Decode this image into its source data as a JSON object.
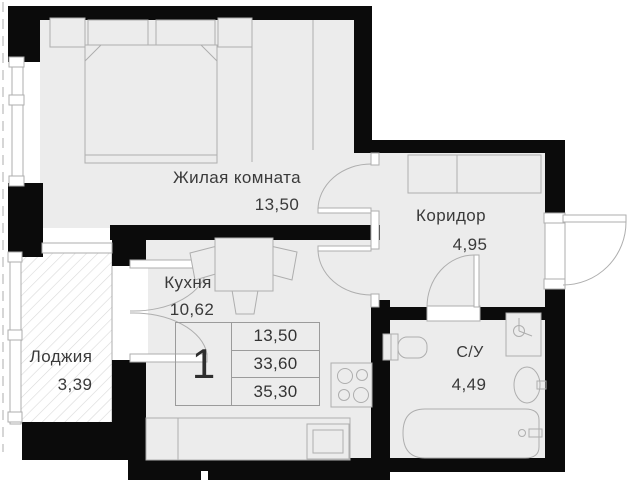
{
  "rooms": {
    "living": {
      "name": "Жилая комната",
      "area": "13,50"
    },
    "corridor": {
      "name": "Коридор",
      "area": "4,95"
    },
    "kitchen": {
      "name": "Кухня",
      "area": "10,62"
    },
    "loggia": {
      "name": "Лоджия",
      "area": "3,39"
    },
    "bathroom": {
      "name": "С/У",
      "area": "4,49"
    }
  },
  "info_table": {
    "apartment_number": "1",
    "rows": [
      "13,50",
      "33,60",
      "35,30"
    ]
  },
  "colors": {
    "wall": "#0b0b0b",
    "floor": "#ececec",
    "line": "#aeaeae",
    "hatch": "#d9d9d9",
    "text": "#3a3a3a"
  }
}
